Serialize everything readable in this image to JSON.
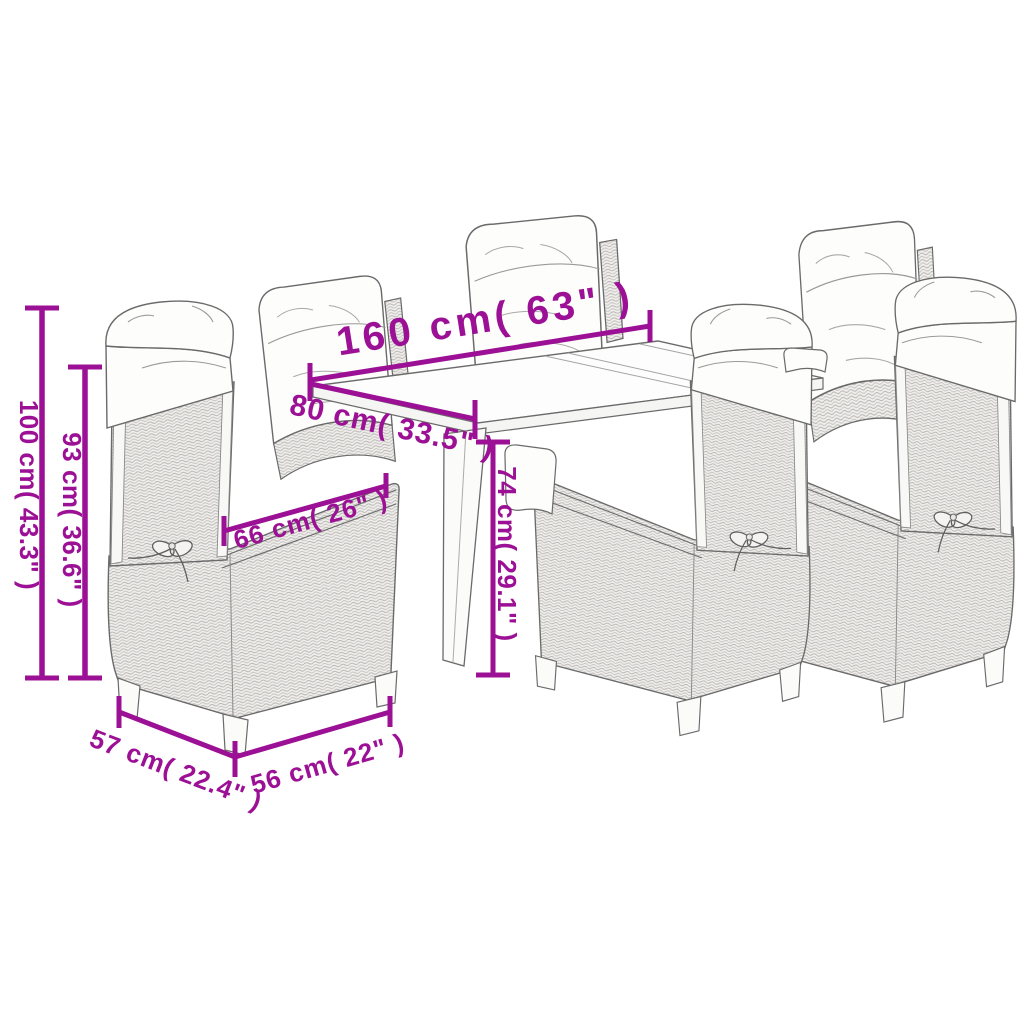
{
  "image_type": "product-dimension-diagram",
  "product": "7-piece outdoor poly rattan dining set (table with 6 reclining chairs, white cushions)",
  "accent_color": "#9C1095",
  "artwork": {
    "stroke_color": "#6a6a6a",
    "wicker_fill": "#efeeec",
    "cushion_fill": "#fdfdfc",
    "background": "#ffffff"
  },
  "dims": [
    {
      "id": "table-length",
      "label": "160 cm( 63\" )"
    },
    {
      "id": "table-width",
      "label": "80 cm( 33.5\" )"
    },
    {
      "id": "chair-height",
      "label": "100 cm( 43.3\" )"
    },
    {
      "id": "chair-back-height",
      "label": "93 cm( 36.6\" )"
    },
    {
      "id": "table-height",
      "label": "74 cm( 29.1\" )"
    },
    {
      "id": "chair-depth",
      "label": "66 cm( 26\" )"
    },
    {
      "id": "chair-side-depth",
      "label": "57 cm( 22.4\" )"
    },
    {
      "id": "chair-width",
      "label": "56 cm( 22\" )"
    }
  ]
}
